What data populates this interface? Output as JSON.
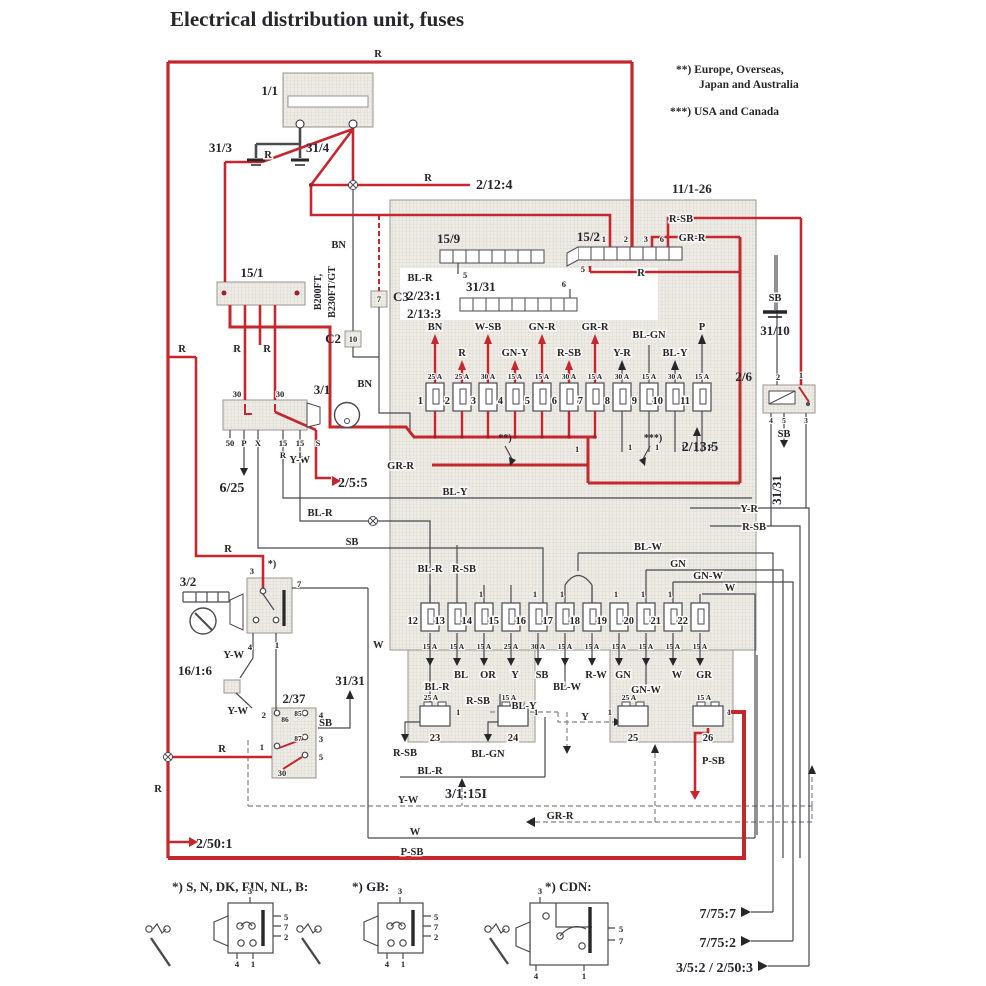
{
  "title": "Electrical distribution unit, fuses",
  "legend": {
    "l1": "**)  Europe, Overseas,",
    "l2": "Japan and Australia",
    "l3": "***)  USA and Canada"
  },
  "refs": {
    "battery": "1/1",
    "g313": "31/3",
    "g314": "31/4",
    "t2124": "2/12:4",
    "unit": "11/1-26",
    "s159": "15/9",
    "s152": "15/2",
    "s151": "15/1",
    "s3131": "31/31",
    "c3": "C3",
    "c2": "C2",
    "eng1": "B200FT,",
    "eng2": "B230FT/GT",
    "c2231": "2/23:1",
    "c2133": "2/13:3",
    "g3110": "31/10",
    "r26": "2/6",
    "i31": "3/1",
    "t625": "6/25",
    "t255": "2/5:5",
    "t2135": "2/13:5",
    "g3131": "31/31",
    "s32": "3/2",
    "star1": "*)",
    "star2": "**)",
    "star3": "***)",
    "c1616": "16/1:6",
    "r237": "2/37",
    "t2501": "2/50:1",
    "t31151": "3/1:15I",
    "t7757": "7/75:7",
    "t7752": "7/75:2",
    "t352": "3/5:2 / 2/50:3",
    "va": "*) S, N, DK, FIN, NL, B:",
    "vb": "*) GB:",
    "vc": "*) CDN:"
  },
  "wires": {
    "r": "R",
    "bn": "BN",
    "rsb": "R-SB",
    "grr": "GR-R",
    "blr": "BL-R",
    "wsb": "W-SB",
    "gny": "GN-Y",
    "gnr": "GN-R",
    "yr": "Y-R",
    "blgn": "BL-GN",
    "bly": "BL-Y",
    "p": "P",
    "sb": "SB",
    "yw": "Y-W",
    "w": "W",
    "blw": "BL-W",
    "gn": "GN",
    "gnw": "GN-W",
    "gr": "GR",
    "or": "OR",
    "y": "Y",
    "bl": "BL",
    "rw": "R-W",
    "psb": "P-SB"
  },
  "pins": {
    "1": "1",
    "2": "2",
    "3": "3",
    "4": "4",
    "5": "5",
    "6": "6",
    "7": "7",
    "10": "10",
    "15": "15",
    "30": "30",
    "50": "50",
    "85": "85",
    "86": "86",
    "87": "87",
    "X": "X",
    "S": "S",
    "P": "P",
    "R": "R",
    "I": "I"
  },
  "fuses": {
    "row1": [
      {
        "n": "1",
        "a": "25 A",
        "w": "BN"
      },
      {
        "n": "2",
        "a": "25 A",
        "w": "R"
      },
      {
        "n": "3",
        "a": "30 A",
        "w": "W-SB"
      },
      {
        "n": "4",
        "a": "15 A",
        "w": "GN-Y"
      },
      {
        "n": "5",
        "a": "15 A",
        "w": "GN-R"
      },
      {
        "n": "6",
        "a": "30 A",
        "w": "R-SB"
      },
      {
        "n": "7",
        "a": "15 A",
        "w": "GR-R"
      },
      {
        "n": "8",
        "a": "30 A",
        "w": "Y-R"
      },
      {
        "n": "9",
        "a": "15 A",
        "w": "BL-GN"
      },
      {
        "n": "10",
        "a": "30 A",
        "w": "BL-Y"
      },
      {
        "n": "11",
        "a": "15 A",
        "w": "P"
      }
    ],
    "row2": [
      {
        "n": "12",
        "a": "15 A",
        "w": ""
      },
      {
        "n": "13",
        "a": "15 A",
        "w": "BL"
      },
      {
        "n": "14",
        "a": "15 A",
        "w": "OR"
      },
      {
        "n": "15",
        "a": "25 A",
        "w": "Y"
      },
      {
        "n": "16",
        "a": "30 A",
        "w": "SB"
      },
      {
        "n": "17",
        "a": "15 A",
        "w": ""
      },
      {
        "n": "18",
        "a": "15 A",
        "w": "R-W"
      },
      {
        "n": "19",
        "a": "15 A",
        "w": "GN"
      },
      {
        "n": "20",
        "a": "15 A",
        "w": ""
      },
      {
        "n": "21",
        "a": "15 A",
        "w": "W"
      },
      {
        "n": "22",
        "a": "15 A",
        "w": "GR"
      }
    ],
    "row3": [
      {
        "n": "23",
        "a": "25 A"
      },
      {
        "n": "24",
        "a": "15 A"
      },
      {
        "n": "25",
        "a": "25 A"
      },
      {
        "n": "26",
        "a": "15 A"
      }
    ]
  },
  "colors": {
    "wire_red": "#c5272d",
    "wire_dark": "#3f3f45",
    "shade_bg": "#edebe6"
  }
}
